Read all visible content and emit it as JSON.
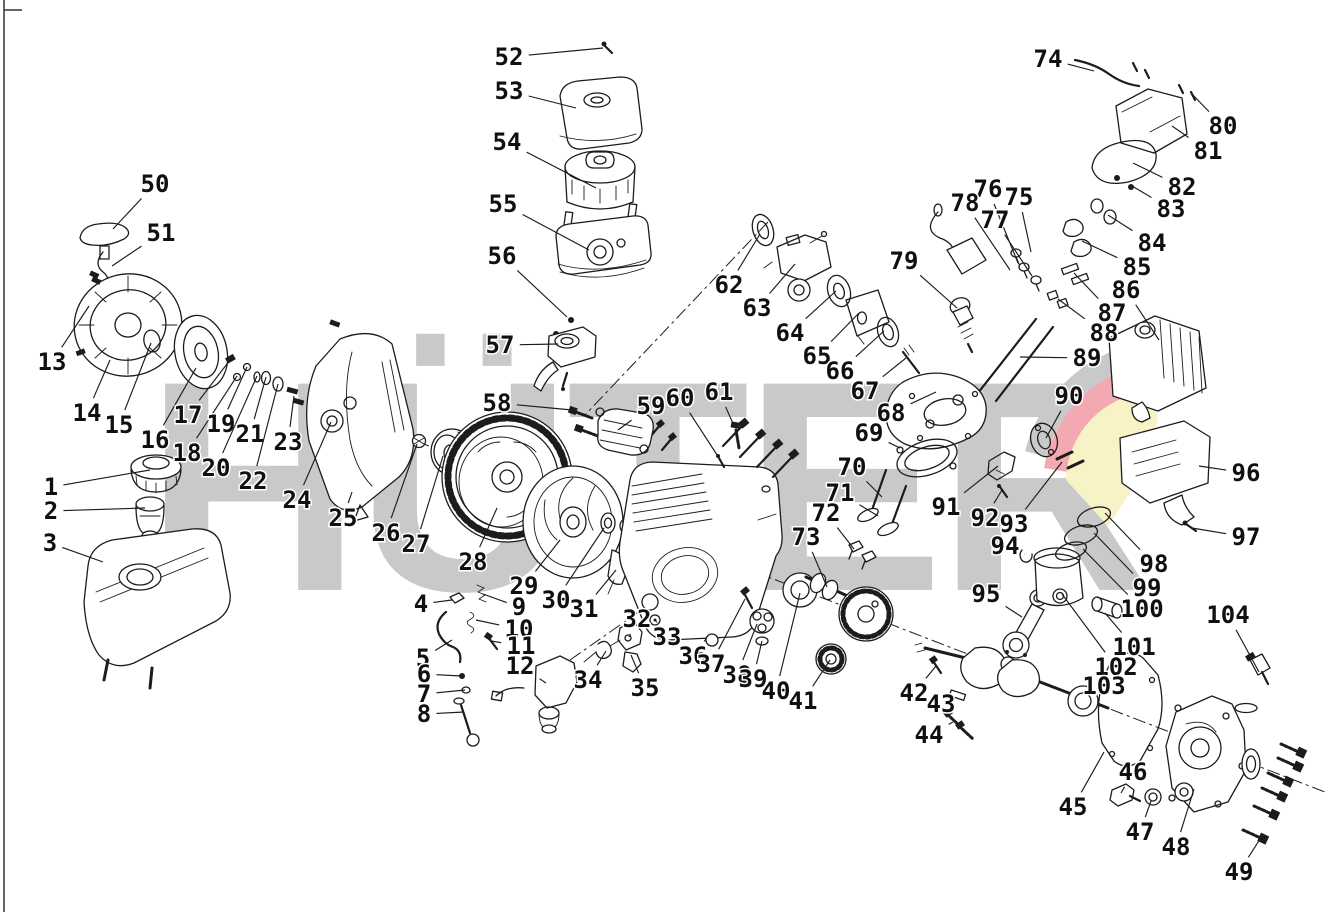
{
  "watermark": {
    "text": "HÜTER",
    "gray": "#c9c9c9",
    "pink": "#f2a9b2",
    "yellow": "#f8f3c6"
  },
  "diagram": {
    "line_color": "#1c1c1c",
    "background": "#ffffff",
    "type": "engine-exploded-parts-diagram"
  },
  "callouts": [
    {
      "n": "1",
      "l": [
        51,
        487
      ],
      "t": [
        150,
        470
      ]
    },
    {
      "n": "2",
      "l": [
        51,
        511
      ],
      "t": [
        145,
        508
      ]
    },
    {
      "n": "3",
      "l": [
        50,
        543
      ],
      "t": [
        103,
        562
      ]
    },
    {
      "n": "4",
      "l": [
        421,
        604
      ],
      "t": [
        452,
        600
      ]
    },
    {
      "n": "5",
      "l": [
        423,
        658
      ],
      "t": [
        452,
        640
      ]
    },
    {
      "n": "6",
      "l": [
        424,
        674
      ],
      "t": [
        461,
        676
      ]
    },
    {
      "n": "7",
      "l": [
        424,
        694
      ],
      "t": [
        465,
        690
      ]
    },
    {
      "n": "8",
      "l": [
        424,
        714
      ],
      "t": [
        464,
        712
      ]
    },
    {
      "n": "9",
      "l": [
        519,
        607
      ],
      "t": [
        483,
        594
      ]
    },
    {
      "n": "10",
      "l": [
        519,
        629
      ],
      "t": [
        476,
        620
      ]
    },
    {
      "n": "11",
      "l": [
        521,
        646
      ],
      "t": [
        491,
        641
      ]
    },
    {
      "n": "12",
      "l": [
        520,
        666
      ],
      "t": [
        546,
        683
      ]
    },
    {
      "n": "13",
      "l": [
        52,
        362
      ],
      "t": [
        89,
        306
      ]
    },
    {
      "n": "14",
      "l": [
        87,
        413
      ],
      "t": [
        110,
        360
      ]
    },
    {
      "n": "15",
      "l": [
        119,
        425
      ],
      "t": [
        151,
        343
      ]
    },
    {
      "n": "16",
      "l": [
        155,
        440
      ],
      "t": [
        196,
        368
      ]
    },
    {
      "n": "17",
      "l": [
        188,
        415
      ],
      "t": [
        230,
        360
      ]
    },
    {
      "n": "18",
      "l": [
        187,
        453
      ],
      "t": [
        237,
        376
      ]
    },
    {
      "n": "19",
      "l": [
        221,
        424
      ],
      "t": [
        247,
        367
      ]
    },
    {
      "n": "20",
      "l": [
        216,
        468
      ],
      "t": [
        257,
        376
      ]
    },
    {
      "n": "21",
      "l": [
        250,
        434
      ],
      "t": [
        266,
        377
      ]
    },
    {
      "n": "22",
      "l": [
        253,
        481
      ],
      "t": [
        278,
        384
      ]
    },
    {
      "n": "23",
      "l": [
        288,
        442
      ],
      "t": [
        294,
        396
      ]
    },
    {
      "n": "24",
      "l": [
        297,
        500
      ],
      "t": [
        331,
        422
      ]
    },
    {
      "n": "25",
      "l": [
        343,
        518
      ],
      "t": [
        352,
        492
      ]
    },
    {
      "n": "26",
      "l": [
        386,
        533
      ],
      "t": [
        417,
        444
      ]
    },
    {
      "n": "27",
      "l": [
        416,
        544
      ],
      "t": [
        443,
        456
      ]
    },
    {
      "n": "28",
      "l": [
        473,
        562
      ],
      "t": [
        497,
        508
      ]
    },
    {
      "n": "29",
      "l": [
        524,
        586
      ],
      "t": [
        560,
        540
      ]
    },
    {
      "n": "30",
      "l": [
        556,
        600
      ],
      "t": [
        604,
        528
      ]
    },
    {
      "n": "31",
      "l": [
        584,
        609
      ],
      "t": [
        616,
        570
      ]
    },
    {
      "n": "32",
      "l": [
        637,
        619
      ],
      "t": [
        629,
        637
      ]
    },
    {
      "n": "33",
      "l": [
        667,
        637
      ],
      "t": [
        656,
        621
      ]
    },
    {
      "n": "34",
      "l": [
        588,
        680
      ],
      "t": [
        606,
        651
      ]
    },
    {
      "n": "35",
      "l": [
        645,
        688
      ],
      "t": [
        631,
        655
      ]
    },
    {
      "n": "36",
      "l": [
        693,
        656
      ],
      "t": [
        706,
        639
      ]
    },
    {
      "n": "37",
      "l": [
        711,
        664
      ],
      "t": [
        745,
        599
      ]
    },
    {
      "n": "38",
      "l": [
        737,
        675
      ],
      "t": [
        757,
        624
      ]
    },
    {
      "n": "39",
      "l": [
        753,
        679
      ],
      "t": [
        762,
        641
      ]
    },
    {
      "n": "40",
      "l": [
        776,
        691
      ],
      "t": [
        800,
        593
      ]
    },
    {
      "n": "41",
      "l": [
        803,
        701
      ],
      "t": [
        830,
        660
      ]
    },
    {
      "n": "42",
      "l": [
        914,
        693
      ],
      "t": [
        936,
        666
      ]
    },
    {
      "n": "43",
      "l": [
        941,
        704
      ],
      "t": [
        956,
        696
      ]
    },
    {
      "n": "44",
      "l": [
        929,
        735
      ],
      "t": [
        953,
        722
      ]
    },
    {
      "n": "45",
      "l": [
        1073,
        807
      ],
      "t": [
        1104,
        752
      ]
    },
    {
      "n": "46",
      "l": [
        1133,
        772
      ],
      "t": [
        1121,
        793
      ]
    },
    {
      "n": "47",
      "l": [
        1140,
        832
      ],
      "t": [
        1151,
        801
      ]
    },
    {
      "n": "48",
      "l": [
        1176,
        847
      ],
      "t": [
        1194,
        789
      ]
    },
    {
      "n": "49",
      "l": [
        1239,
        872
      ],
      "t": [
        1262,
        836
      ]
    },
    {
      "n": "50",
      "l": [
        155,
        184
      ],
      "t": [
        113,
        229
      ]
    },
    {
      "n": "51",
      "l": [
        161,
        233
      ],
      "t": [
        112,
        266
      ]
    },
    {
      "n": "52",
      "l": [
        509,
        57
      ],
      "t": [
        603,
        48
      ]
    },
    {
      "n": "53",
      "l": [
        509,
        91
      ],
      "t": [
        576,
        108
      ]
    },
    {
      "n": "54",
      "l": [
        507,
        142
      ],
      "t": [
        596,
        188
      ]
    },
    {
      "n": "55",
      "l": [
        503,
        204
      ],
      "t": [
        589,
        250
      ]
    },
    {
      "n": "56",
      "l": [
        502,
        256
      ],
      "t": [
        567,
        317
      ]
    },
    {
      "n": "57",
      "l": [
        500,
        345
      ],
      "t": [
        558,
        344
      ]
    },
    {
      "n": "58",
      "l": [
        497,
        403
      ],
      "t": [
        572,
        410
      ]
    },
    {
      "n": "59",
      "l": [
        651,
        406
      ],
      "t": [
        618,
        430
      ]
    },
    {
      "n": "60",
      "l": [
        680,
        398
      ],
      "t": [
        721,
        461
      ]
    },
    {
      "n": "61",
      "l": [
        719,
        392
      ],
      "t": [
        735,
        428
      ]
    },
    {
      "n": "62",
      "l": [
        729,
        285
      ],
      "t": [
        760,
        234
      ]
    },
    {
      "n": "63",
      "l": [
        757,
        308
      ],
      "t": [
        795,
        264
      ]
    },
    {
      "n": "64",
      "l": [
        790,
        333
      ],
      "t": [
        836,
        291
      ]
    },
    {
      "n": "65",
      "l": [
        817,
        356
      ],
      "t": [
        859,
        313
      ]
    },
    {
      "n": "66",
      "l": [
        840,
        371
      ],
      "t": [
        884,
        331
      ]
    },
    {
      "n": "67",
      "l": [
        865,
        391
      ],
      "t": [
        906,
        358
      ]
    },
    {
      "n": "68",
      "l": [
        891,
        413
      ],
      "t": [
        936,
        392
      ]
    },
    {
      "n": "69",
      "l": [
        869,
        433
      ],
      "t": [
        900,
        448
      ]
    },
    {
      "n": "70",
      "l": [
        852,
        467
      ],
      "t": [
        882,
        497
      ]
    },
    {
      "n": "71",
      "l": [
        840,
        493
      ],
      "t": [
        878,
        516
      ]
    },
    {
      "n": "72",
      "l": [
        826,
        513
      ],
      "t": [
        854,
        549
      ]
    },
    {
      "n": "73",
      "l": [
        806,
        537
      ],
      "t": [
        827,
        587
      ]
    },
    {
      "n": "74",
      "l": [
        1048,
        59
      ],
      "t": [
        1094,
        71
      ]
    },
    {
      "n": "75",
      "l": [
        1019,
        197
      ],
      "t": [
        1031,
        252
      ]
    },
    {
      "n": "76",
      "l": [
        988,
        189
      ],
      "t": [
        1018,
        263
      ]
    },
    {
      "n": "77",
      "l": [
        995,
        220
      ],
      "t": [
        1032,
        276
      ]
    },
    {
      "n": "78",
      "l": [
        965,
        203
      ],
      "t": [
        1010,
        270
      ]
    },
    {
      "n": "79",
      "l": [
        904,
        261
      ],
      "t": [
        957,
        308
      ]
    },
    {
      "n": "80",
      "l": [
        1223,
        126
      ],
      "t": [
        1191,
        93
      ]
    },
    {
      "n": "81",
      "l": [
        1208,
        151
      ],
      "t": [
        1172,
        126
      ]
    },
    {
      "n": "82",
      "l": [
        1182,
        187
      ],
      "t": [
        1133,
        163
      ]
    },
    {
      "n": "83",
      "l": [
        1171,
        209
      ],
      "t": [
        1132,
        186
      ]
    },
    {
      "n": "84",
      "l": [
        1152,
        243
      ],
      "t": [
        1108,
        215
      ]
    },
    {
      "n": "85",
      "l": [
        1137,
        267
      ],
      "t": [
        1082,
        241
      ]
    },
    {
      "n": "86",
      "l": [
        1126,
        290
      ],
      "t": [
        1159,
        340
      ]
    },
    {
      "n": "87",
      "l": [
        1112,
        313
      ],
      "t": [
        1074,
        273
      ]
    },
    {
      "n": "88",
      "l": [
        1104,
        333
      ],
      "t": [
        1058,
        299
      ]
    },
    {
      "n": "89",
      "l": [
        1087,
        358
      ],
      "t": [
        1020,
        357
      ]
    },
    {
      "n": "90",
      "l": [
        1069,
        396
      ],
      "t": [
        1046,
        438
      ]
    },
    {
      "n": "91",
      "l": [
        946,
        507
      ],
      "t": [
        998,
        466
      ]
    },
    {
      "n": "92",
      "l": [
        985,
        518
      ],
      "t": [
        1002,
        490
      ]
    },
    {
      "n": "93",
      "l": [
        1014,
        524
      ],
      "t": [
        1062,
        462
      ]
    },
    {
      "n": "94",
      "l": [
        1005,
        546
      ],
      "t": [
        1025,
        554
      ]
    },
    {
      "n": "95",
      "l": [
        986,
        594
      ],
      "t": [
        1022,
        617
      ]
    },
    {
      "n": "96",
      "l": [
        1246,
        473
      ],
      "t": [
        1199,
        466
      ]
    },
    {
      "n": "97",
      "l": [
        1246,
        537
      ],
      "t": [
        1192,
        528
      ]
    },
    {
      "n": "98",
      "l": [
        1154,
        564
      ],
      "t": [
        1105,
        513
      ]
    },
    {
      "n": "99",
      "l": [
        1147,
        588
      ],
      "t": [
        1094,
        533
      ]
    },
    {
      "n": "100",
      "l": [
        1142,
        609
      ],
      "t": [
        1083,
        549
      ]
    },
    {
      "n": "101",
      "l": [
        1134,
        647
      ],
      "t": [
        1105,
        613
      ]
    },
    {
      "n": "102",
      "l": [
        1116,
        667
      ],
      "t": [
        1062,
        594
      ]
    },
    {
      "n": "103",
      "l": [
        1104,
        686
      ],
      "t": [
        1081,
        699
      ]
    },
    {
      "n": "104",
      "l": [
        1228,
        615
      ],
      "t": [
        1259,
        672
      ]
    }
  ]
}
